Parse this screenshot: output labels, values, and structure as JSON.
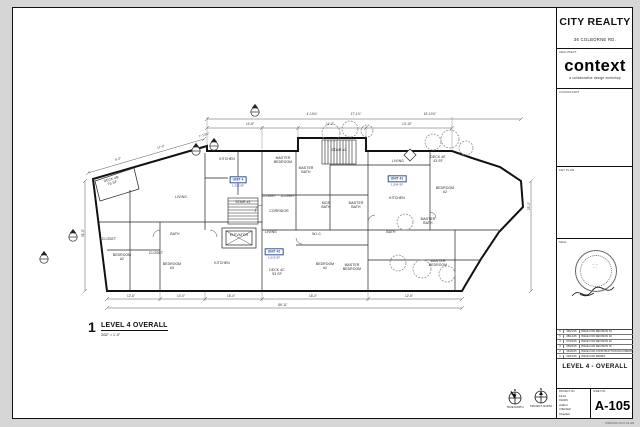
{
  "titleblock": {
    "client": "CITY REALTY",
    "address": "36 COLBORNE RD.",
    "architect_label": "ARCHITECT",
    "logo": "context",
    "logo_tagline": "a collaborative design workshop",
    "consultant_label": "CONSULTANT",
    "keyplan_label": "KEY PLAN",
    "seal_label": "SEAL",
    "sheet_title": "LEVEL 4 - OVERALL",
    "project_no_label": "PROJECT NO.",
    "project_no": "1414",
    "drawn_label": "DRAWN",
    "drawn": "Author",
    "checked_label": "CHECKED",
    "checked": "Checker",
    "sheet_no_label": "SHEET NO.",
    "sheet_no": "A-105",
    "plot_stamp": "4/30/2015 10:07:42 AM"
  },
  "revisions": [
    {
      "no": "6",
      "date": "09/21/15",
      "desc": "ISSUE FOR REVISION 04"
    },
    {
      "no": "5",
      "date": "08/14/15",
      "desc": "ISSUE FOR REVISION 03"
    },
    {
      "no": "4",
      "date": "07/02/15",
      "desc": "ISSUE FOR REVISION 02"
    },
    {
      "no": "3",
      "date": "05/18/15",
      "desc": "ISSUE FOR REVISION 01"
    },
    {
      "no": "2",
      "date": "04/30/15",
      "desc": "ISSUE FOR CONSTRUCTION DOCUMENTS"
    },
    {
      "no": "1",
      "date": "03/15/15",
      "desc": "ISSUE FOR PERMIT"
    }
  ],
  "view": {
    "number": "1",
    "title": "LEVEL 4 OVERALL",
    "scale": "3/32\" = 1'-0\""
  },
  "north": {
    "true_label": "TRUE NORTH",
    "project_label": "PROJECT NORTH",
    "n": "N"
  },
  "plan": {
    "units": [
      {
        "name": "UNIT 4",
        "area": "1,313 SF"
      },
      {
        "name": "UNIT 41",
        "area": "1,504 SF"
      },
      {
        "name": "UNIT 42",
        "area": "1,019 SF"
      }
    ],
    "rooms": [
      "DECK 4B\n75 SF",
      "KITCHEN",
      "LIVING",
      "STAIR #1",
      "MASTER\nBEDROOM",
      "MASTER\nBATH",
      "CLOSET",
      "CLOSET",
      "CORRIDOR",
      "KIDS\nBATH",
      "MASTER\nBATH",
      "ELEVATOR",
      "LIVING",
      "W.I.C.",
      "KITCHEN",
      "BATH",
      "CLOSET",
      "BEDROOM\n#2",
      "CLOSET",
      "BEDROOM\n#3",
      "LIVING",
      "KITCHEN",
      "DECK 4E\n43 SF",
      "BEDROOM\n#2",
      "MASTER\nBATH",
      "BEDROOM\n#2",
      "MASTER\nBEDROOM",
      "DECK 4C\n93 SF",
      "MASTER\nBEDROOM",
      "BATH",
      "STAIR #2"
    ],
    "dims": [
      "5'-2\"",
      "17'-0\"",
      "1'-10⅝\"",
      "14'-8\"",
      "11'-2\"",
      "13'-10\"",
      "4'-10¾\"",
      "17'-1⅞\"",
      "15'-10⅞\"",
      "12'-6\"",
      "10'-0\"",
      "15'-4\"",
      "18'-0\"",
      "12'-6\"",
      "86'-11\"",
      "31'-0\"",
      "25'-2\""
    ]
  }
}
